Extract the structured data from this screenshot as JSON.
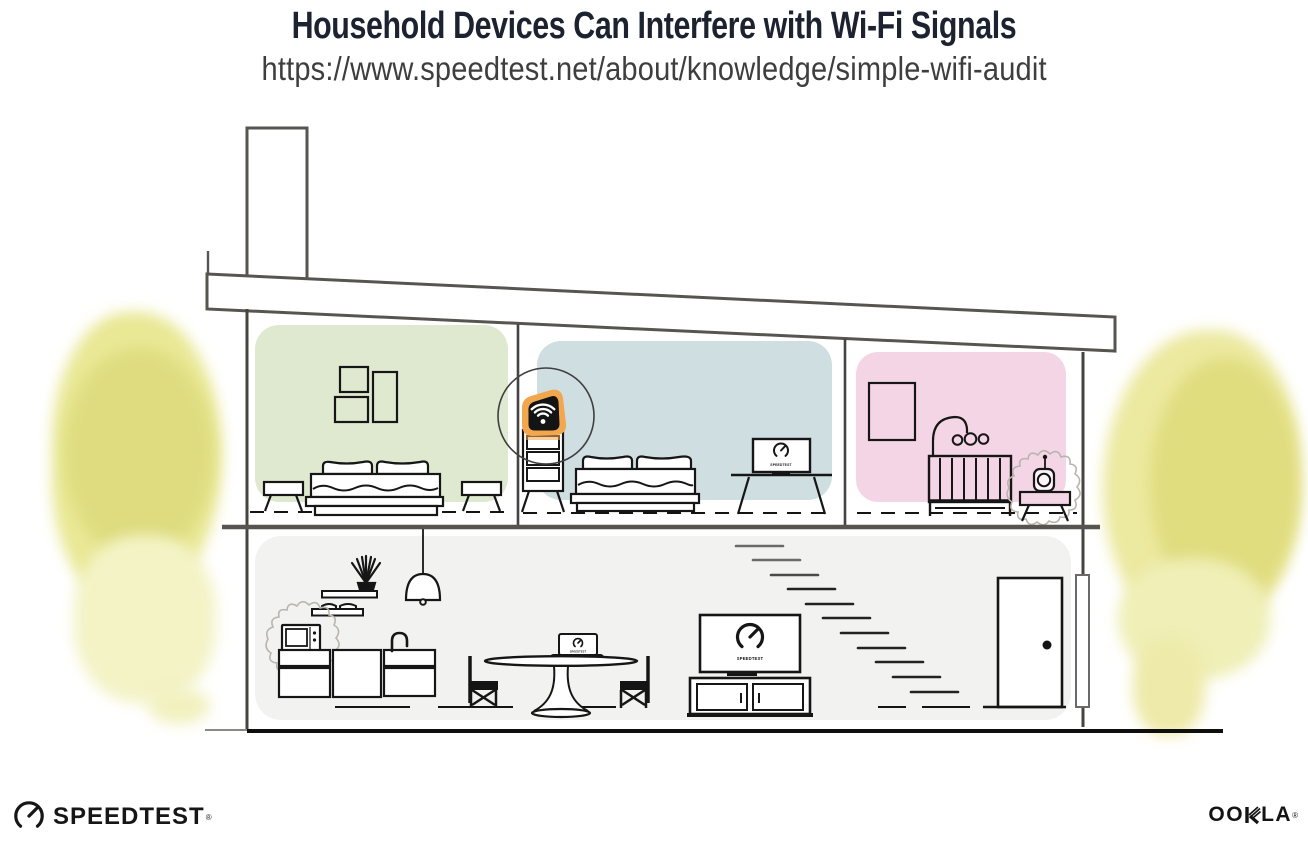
{
  "header": {
    "title": "Household Devices Can Interfere with Wi-Fi Signals",
    "url": "https://www.speedtest.net/about/knowledge/simple-wifi-audit"
  },
  "illustration": {
    "bedroom_tv_screen_label": "SPEEDTEST",
    "laptop_screen_label": "SPEEDTEST",
    "living_room_tv_screen_label": "SPEEDTEST",
    "rooms": [
      {
        "name": "green-bedroom"
      },
      {
        "name": "blue-bedroom-with-router"
      },
      {
        "name": "pink-nursery"
      },
      {
        "name": "downstairs-kitchen-living-room"
      }
    ],
    "devices": [
      {
        "name": "wifi-router",
        "icon": "wifi-icon",
        "highlighted": true
      },
      {
        "name": "bedroom-tv",
        "icon": "speedtest-gauge-icon"
      },
      {
        "name": "baby-monitor",
        "interference": true
      },
      {
        "name": "microwave",
        "interference": true
      },
      {
        "name": "laptop",
        "icon": "speedtest-gauge-icon"
      },
      {
        "name": "living-room-tv",
        "icon": "speedtest-gauge-icon"
      }
    ],
    "colors": {
      "accent_orange": "#F2A64E",
      "green_wall": "#DEE9D0",
      "blue_wall": "#CEDEE1",
      "pink_wall": "#F4D5E5",
      "downstairs_wall": "#F2F2F0",
      "foliage_yellow": "#E4E48A",
      "line_art": "#161616",
      "structure_gray": "#56554F"
    }
  },
  "footer": {
    "speedtest_wordmark": "SPEEDTEST",
    "speedtest_reg_mark": "®",
    "ookla_wordmark_left": "OO",
    "ookla_wordmark_right": "LA",
    "ookla_reg_mark": "®"
  }
}
